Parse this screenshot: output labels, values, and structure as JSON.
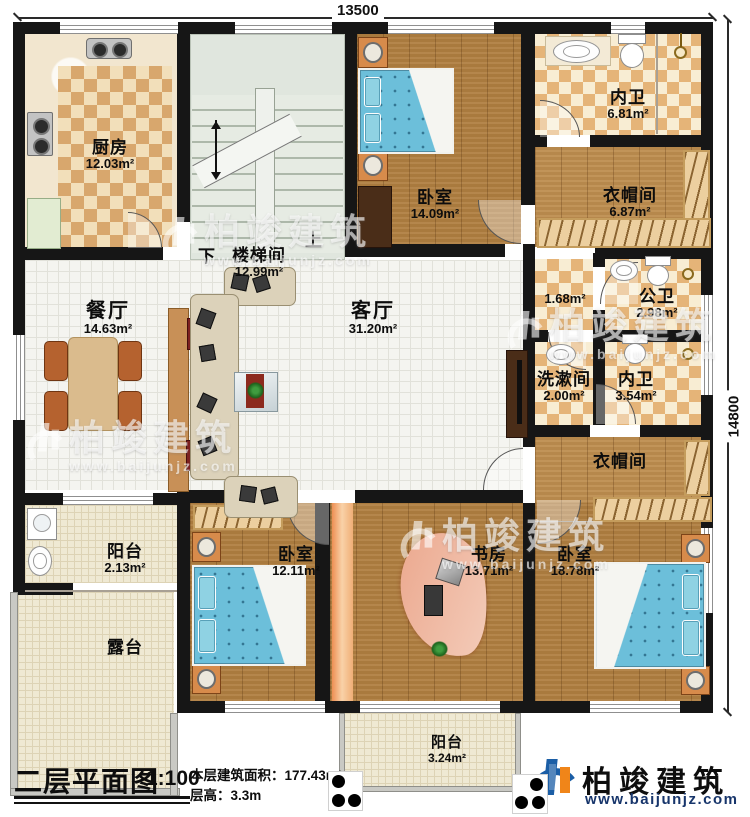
{
  "dimensions": {
    "width": "13500",
    "height": "14800"
  },
  "rooms": {
    "kitchen": {
      "name": "厨房",
      "area": "12.03m²"
    },
    "stairwell": {
      "name": "楼梯间",
      "area": "12.99m²",
      "down": "下",
      "up": "上"
    },
    "bedroom_top": {
      "name": "卧室",
      "area": "14.09m²"
    },
    "bath_top": {
      "name": "内卫",
      "area": "6.81m²"
    },
    "cloak_top": {
      "name": "衣帽间",
      "area": "6.87m²"
    },
    "hall": {
      "name": "",
      "area": "1.68m²"
    },
    "public_bath": {
      "name": "公卫",
      "area": "2.98m²"
    },
    "washroom": {
      "name": "洗漱间",
      "area": "2.00m²"
    },
    "bath_mid": {
      "name": "内卫",
      "area": "3.54m²"
    },
    "cloak_mid": {
      "name": "衣帽间",
      "area": ""
    },
    "dining": {
      "name": "餐厅",
      "area": "14.63m²"
    },
    "living": {
      "name": "客厅",
      "area": "31.20m²"
    },
    "balcony_left": {
      "name": "阳台",
      "area": "2.13m²"
    },
    "terrace": {
      "name": "露台",
      "area": ""
    },
    "bedroom_left": {
      "name": "卧室",
      "area": "12.11m²"
    },
    "study": {
      "name": "书房",
      "area": "13.71m²"
    },
    "bedroom_right": {
      "name": "卧室",
      "area": "18.78m²"
    },
    "balcony_bottom": {
      "name": "阳台",
      "area": "3.24m²"
    }
  },
  "title_block": {
    "title": "二层平面图",
    "scale": "1:100",
    "area_label": "本层建筑面积：",
    "area_value": "177.43m²",
    "floor_height_label": "层高：",
    "floor_height_value": "3.3m"
  },
  "brand": {
    "name": "柏竣建筑",
    "url": "www.baijunjz.com"
  },
  "watermark": {
    "name": "柏竣建筑",
    "url": "www.baijunjz.com"
  },
  "colors": {
    "brand_blue": "#1b5ea6",
    "brand_orange": "#f08519",
    "wall": "#161616"
  }
}
